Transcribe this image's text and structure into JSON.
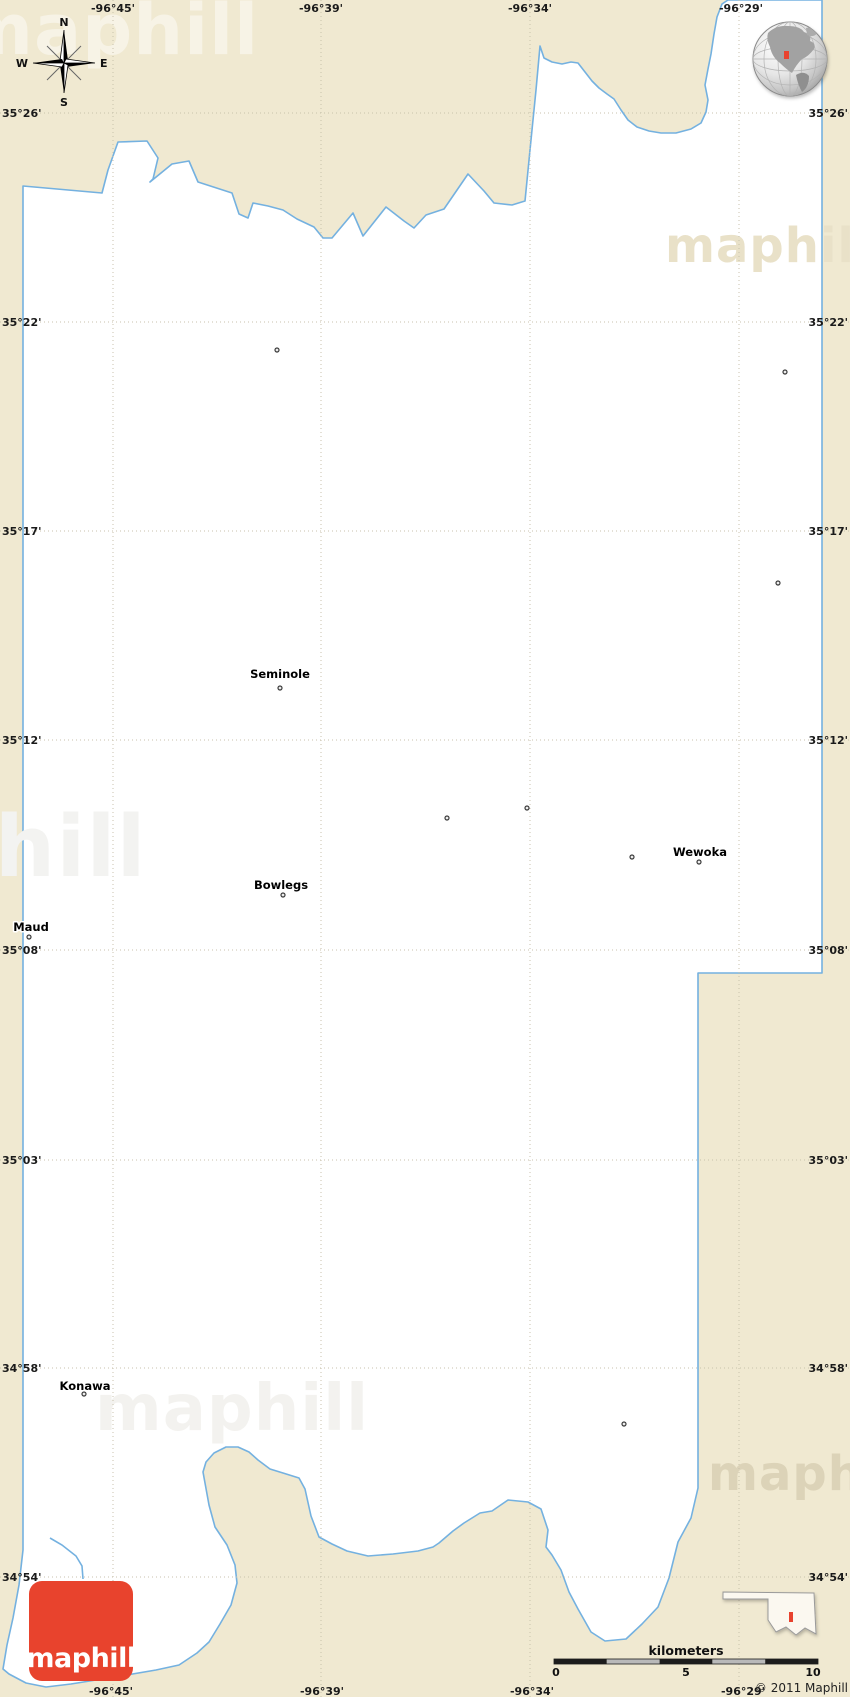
{
  "map": {
    "colors": {
      "background": "#f0e9d1",
      "county_fill": "#ffffff",
      "county_border": "#74b1e0",
      "grid": "#c8c2ac",
      "label": "#1a1a1a",
      "logo_red": "#e8432d",
      "marker_red": "#e8432d",
      "scale_dark": "#1c1c1c",
      "scale_light": "#b9b9b9"
    },
    "compass": {
      "n": "N",
      "e": "E",
      "s": "S",
      "w": "W"
    },
    "graticule": {
      "x_lines": [
        113,
        321,
        530,
        739
      ],
      "y_lines": [
        113,
        322,
        531,
        740,
        950,
        1160,
        1368,
        1577
      ]
    },
    "labels": {
      "top": [
        {
          "text": "-96°45'",
          "x": 113
        },
        {
          "text": "-96°39'",
          "x": 321
        },
        {
          "text": "-96°34'",
          "x": 530
        },
        {
          "text": "-96°29'",
          "x": 741
        }
      ],
      "bottom": [
        {
          "text": "-96°45'",
          "x": 111
        },
        {
          "text": "-96°39'",
          "x": 322
        },
        {
          "text": "-96°34'",
          "x": 532
        },
        {
          "text": "-96°29'",
          "x": 743
        }
      ],
      "left": [
        {
          "text": "35°26'",
          "y": 113
        },
        {
          "text": "35°22'",
          "y": 322
        },
        {
          "text": "35°17'",
          "y": 531
        },
        {
          "text": "35°12'",
          "y": 740
        },
        {
          "text": "35°08'",
          "y": 950
        },
        {
          "text": "35°03'",
          "y": 1160
        },
        {
          "text": "34°58'",
          "y": 1368
        },
        {
          "text": "34°54'",
          "y": 1577
        }
      ],
      "right": [
        {
          "text": "35°26'",
          "y": 113
        },
        {
          "text": "35°22'",
          "y": 322
        },
        {
          "text": "35°17'",
          "y": 531
        },
        {
          "text": "35°12'",
          "y": 740
        },
        {
          "text": "35°08'",
          "y": 950
        },
        {
          "text": "35°03'",
          "y": 1160
        },
        {
          "text": "34°58'",
          "y": 1368
        },
        {
          "text": "34°54'",
          "y": 1577
        }
      ]
    },
    "cities": [
      {
        "name": "Seminole",
        "label_x": 280,
        "label_y": 678,
        "dot_x": 280,
        "dot_y": 688
      },
      {
        "name": "Bowlegs",
        "label_x": 281,
        "label_y": 889,
        "dot_x": 283,
        "dot_y": 895
      },
      {
        "name": "Maud",
        "label_x": 31,
        "label_y": 931,
        "dot_x": 29,
        "dot_y": 937
      },
      {
        "name": "Wewoka",
        "label_x": 700,
        "label_y": 856,
        "dot_x": 699,
        "dot_y": 862
      },
      {
        "name": "Konawa",
        "label_x": 85,
        "label_y": 1390,
        "dot_x": 84,
        "dot_y": 1394
      }
    ],
    "towns": [
      {
        "x": 277,
        "y": 350
      },
      {
        "x": 785,
        "y": 372
      },
      {
        "x": 778,
        "y": 583
      },
      {
        "x": 527,
        "y": 808
      },
      {
        "x": 447,
        "y": 818
      },
      {
        "x": 632,
        "y": 857
      },
      {
        "x": 624,
        "y": 1424
      }
    ],
    "scalebar": {
      "title": "kilometers",
      "x": 554,
      "y": 1659,
      "width": 264,
      "height": 5,
      "segments": [
        "dark",
        "light",
        "dark",
        "light",
        "dark"
      ],
      "ticks": [
        {
          "text": "0",
          "x": 556
        },
        {
          "text": "5",
          "x": 686
        },
        {
          "text": "10",
          "x": 813
        }
      ]
    },
    "copyright": "© 2011 Maphill",
    "logo": {
      "text": "maphill"
    },
    "watermark": {
      "text": "maphill"
    }
  }
}
